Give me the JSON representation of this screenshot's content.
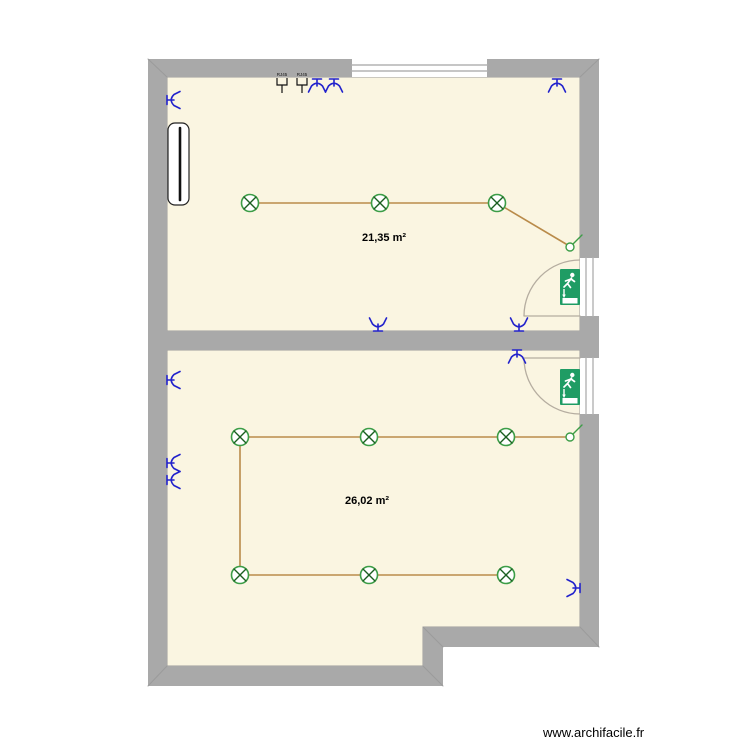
{
  "watermark": "www.archifacile.fr",
  "colors": {
    "wall": "#a9a9a9",
    "wall_edge": "#9b9b9b",
    "floor": "#faf5e1",
    "floor_edge": "#9c9c9c",
    "wire": "#b98b4a",
    "fixture_green": "#3c9d47",
    "fixture_x": "#1b5e20",
    "outlet_blue": "#2222cc",
    "exit_green": "#1f9c64",
    "door_arc": "#b5ada0",
    "door_stripe": "#b3b3b3",
    "rj45_black": "#111111",
    "label": "#000000"
  },
  "rooms": [
    {
      "name": "room-1",
      "area_label": "21,35 m²",
      "label_x": 384,
      "label_y": 238
    },
    {
      "name": "room-2",
      "area_label": "26,02 m²",
      "label_x": 367,
      "label_y": 501
    }
  ],
  "plan": {
    "floors": [
      {
        "name": "floor-room-1",
        "d": "M167,77 H580 V331 H167 Z"
      },
      {
        "name": "floor-room-2",
        "d": "M167,350 H580 V627 H423 V666 H167 Z"
      }
    ],
    "walls": [
      {
        "name": "wall-top",
        "x": 148,
        "y": 59,
        "w": 451,
        "h": 18
      },
      {
        "name": "wall-left",
        "x": 148,
        "y": 59,
        "w": 19,
        "h": 627
      },
      {
        "name": "wall-right",
        "x": 580,
        "y": 59,
        "w": 19,
        "h": 588
      },
      {
        "name": "wall-middle",
        "x": 167,
        "y": 331,
        "w": 413,
        "h": 19
      },
      {
        "name": "wall-bottom",
        "x": 148,
        "y": 666,
        "w": 295,
        "h": 20
      },
      {
        "name": "wall-notch-bottom",
        "x": 423,
        "y": 627,
        "w": 176,
        "h": 20
      },
      {
        "name": "wall-notch-side",
        "x": 423,
        "y": 627,
        "w": 20,
        "h": 59
      }
    ],
    "miters": [
      [
        148,
        59,
        167,
        77
      ],
      [
        599,
        59,
        580,
        77
      ],
      [
        148,
        686,
        167,
        666
      ],
      [
        599,
        647,
        580,
        627
      ],
      [
        443,
        686,
        423,
        666
      ],
      [
        443,
        647,
        423,
        627
      ]
    ],
    "window": {
      "name": "window",
      "x": 352,
      "y": 59,
      "w": 135,
      "h": 18
    },
    "doors": [
      {
        "name": "door-room-1",
        "rect": {
          "x": 580,
          "y": 258,
          "w": 19,
          "h": 58
        },
        "stripes": [
          [
            586,
            258,
            586,
            316
          ],
          [
            593,
            258,
            593,
            316
          ]
        ],
        "leaf": [
          580,
          316,
          524,
          316
        ],
        "arc": "M524,316 A56,56 0 0 1 580,260"
      },
      {
        "name": "door-room-2",
        "rect": {
          "x": 580,
          "y": 358,
          "w": 19,
          "h": 56
        },
        "stripes": [
          [
            586,
            358,
            586,
            414
          ],
          [
            593,
            358,
            593,
            414
          ]
        ],
        "leaf": [
          580,
          358,
          524,
          358
        ],
        "arc": "M524,358 A56,56 0 0 0 580,414"
      }
    ],
    "wires": [
      [
        250,
        203,
        497,
        203
      ],
      [
        497,
        203,
        566,
        244
      ],
      [
        240,
        437,
        506,
        437
      ],
      [
        506,
        437,
        566,
        437
      ],
      [
        240,
        437,
        240,
        575
      ],
      [
        240,
        575,
        506,
        575
      ]
    ],
    "lights": [
      [
        250,
        203
      ],
      [
        380,
        203
      ],
      [
        497,
        203
      ],
      [
        240,
        437
      ],
      [
        369,
        437
      ],
      [
        506,
        437
      ],
      [
        240,
        575
      ],
      [
        369,
        575
      ],
      [
        506,
        575
      ]
    ],
    "switches": [
      {
        "x": 570,
        "y": 247,
        "tail": [
          573,
          244,
          582,
          235
        ]
      },
      {
        "x": 570,
        "y": 437,
        "tail": [
          573,
          434,
          582,
          425
        ]
      }
    ],
    "outlets": [
      {
        "x": 317,
        "y": 86,
        "rot": 0
      },
      {
        "x": 334,
        "y": 86,
        "rot": 0
      },
      {
        "x": 557,
        "y": 86,
        "rot": 0
      },
      {
        "x": 174,
        "y": 100,
        "rot": 270
      },
      {
        "x": 378,
        "y": 324,
        "rot": 180
      },
      {
        "x": 519,
        "y": 324,
        "rot": 180
      },
      {
        "x": 517,
        "y": 357,
        "rot": 0
      },
      {
        "x": 174,
        "y": 380,
        "rot": 270
      },
      {
        "x": 174,
        "y": 463,
        "rot": 270
      },
      {
        "x": 174,
        "y": 480,
        "rot": 270
      },
      {
        "x": 573,
        "y": 588,
        "rot": 90
      }
    ],
    "rj45_sockets": [
      {
        "x": 282,
        "y": 85,
        "label": "RJ45"
      },
      {
        "x": 302,
        "y": 85,
        "label": "RJ45"
      }
    ],
    "exit_signs": [
      {
        "x": 560,
        "y": 269
      },
      {
        "x": 560,
        "y": 369
      }
    ],
    "radiator": {
      "x": 168,
      "y": 123,
      "w": 21,
      "h": 82
    }
  }
}
